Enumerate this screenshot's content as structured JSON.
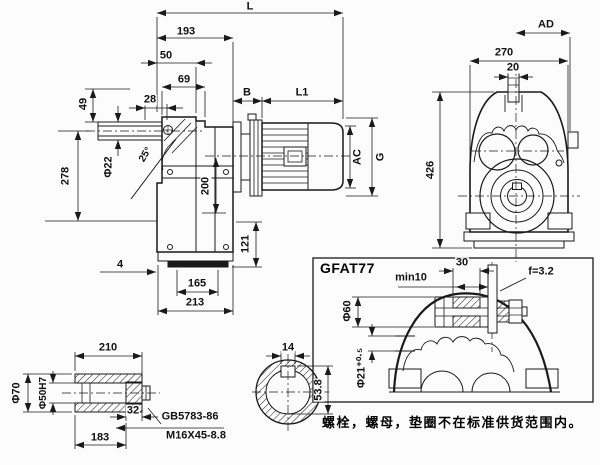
{
  "side_view": {
    "dims": {
      "L": "L",
      "d193": "193",
      "d50": "50",
      "d69": "69",
      "d28": "28",
      "d49": "49",
      "B": "B",
      "L1": "L1",
      "phi22": "Φ22",
      "angle25": "25°",
      "d278": "278",
      "d200": "200",
      "d121": "121",
      "d4": "4",
      "d165": "165",
      "d213": "213",
      "AC": "AC",
      "G": "G"
    }
  },
  "front_view": {
    "dims": {
      "AD": "AD",
      "d270": "270",
      "d20": "20",
      "d426": "426"
    }
  },
  "shaft_detail": {
    "dims": {
      "d210": "210",
      "phi70": "Φ70",
      "phi50h7": "Φ50H7",
      "d32": "32",
      "d183": "183"
    },
    "labels": {
      "standard": "GB5783-86",
      "bolt": "M16X45-8.8"
    }
  },
  "key_section": {
    "dims": {
      "d14": "14",
      "d53_8": "53.8"
    }
  },
  "mount_detail": {
    "title": "GFAT77",
    "dims": {
      "min10": "min10",
      "d30": "30",
      "f": "f=3.2",
      "phi60": "Φ60",
      "phi21": "Φ21⁺⁰·⁵"
    }
  },
  "note": "螺栓，螺母，垫圈不在标准供货范围内。"
}
